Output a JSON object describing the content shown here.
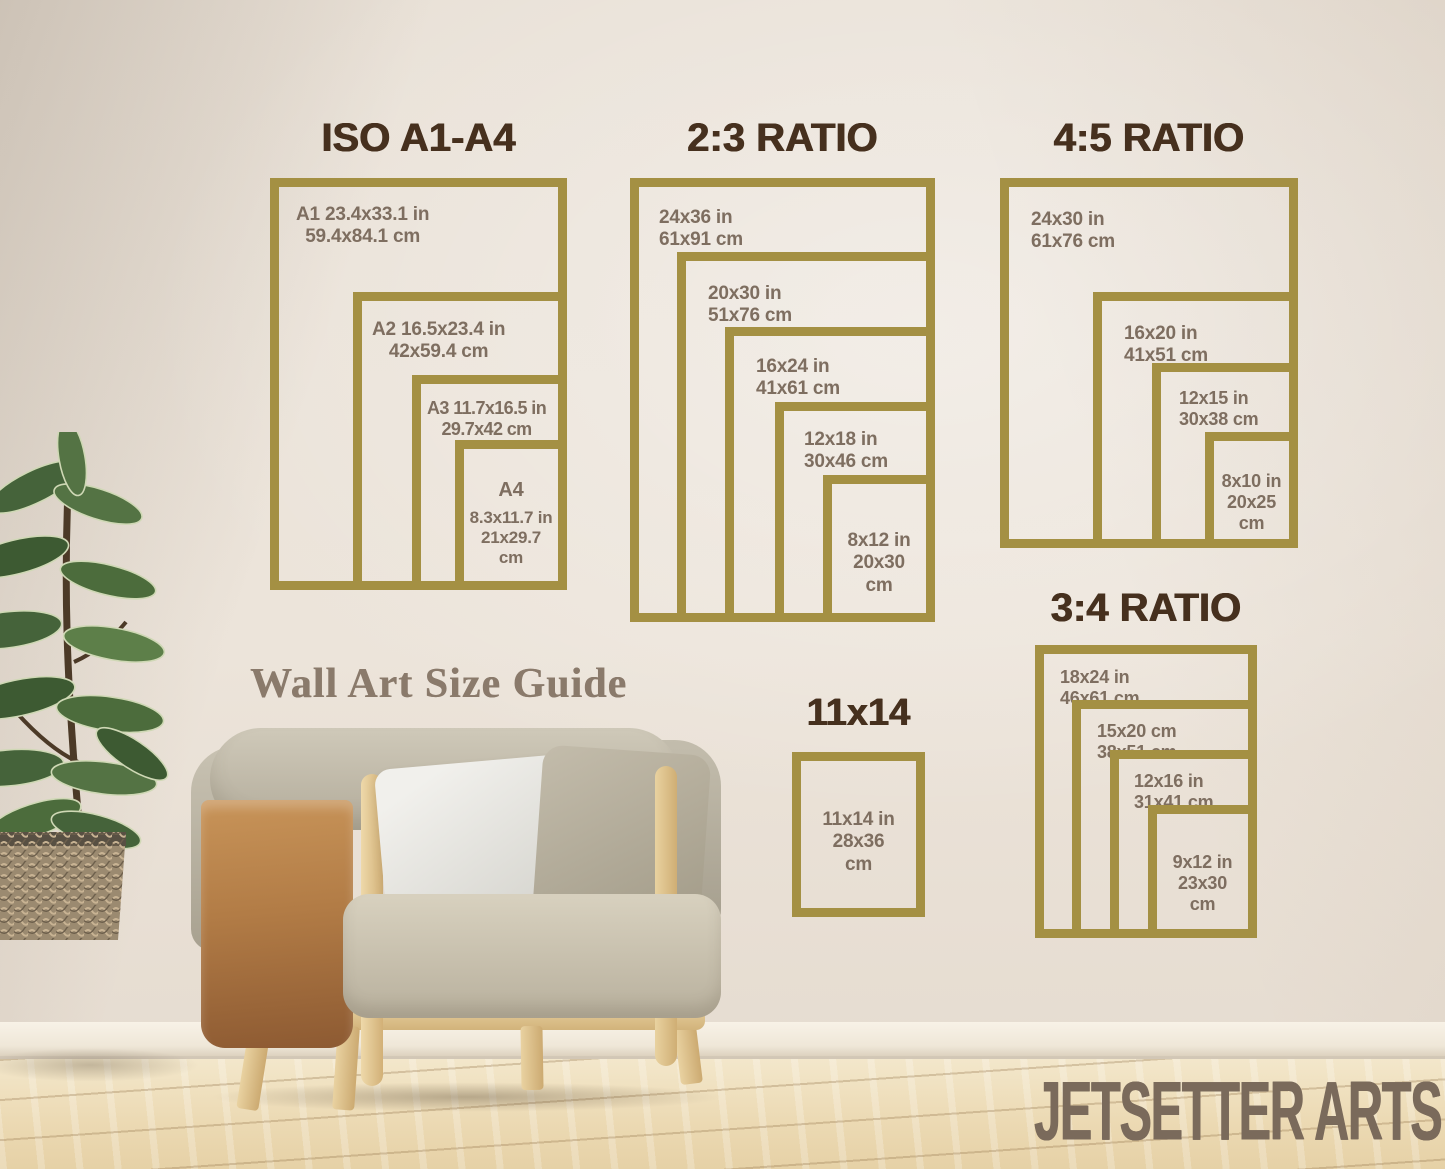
{
  "brand": "JETSETTER ARTS",
  "guide_title": "Wall Art Size Guide",
  "colors": {
    "frame_gold": "#a49043",
    "title_brown": "#46301e",
    "label_brown": "#7e6e60",
    "wall_cream": "#ece4da"
  },
  "sections": [
    {
      "title": "ISO A1-A4",
      "frames": [
        {
          "lines": [
            "A1 23.4x33.1 in",
            "59.4x84.1 cm"
          ]
        },
        {
          "lines": [
            "A2 16.5x23.4 in",
            "42x59.4 cm"
          ]
        },
        {
          "lines": [
            "A3 11.7x16.5 in",
            "29.7x42 cm"
          ]
        },
        {
          "lines": [
            "A4",
            "8.3x11.7 in",
            "21x29.7",
            "cm"
          ]
        }
      ]
    },
    {
      "title": "2:3 RATIO",
      "frames": [
        {
          "lines": [
            "24x36 in",
            "61x91 cm"
          ]
        },
        {
          "lines": [
            "20x30 in",
            "51x76 cm"
          ]
        },
        {
          "lines": [
            "16x24 in",
            "41x61 cm"
          ]
        },
        {
          "lines": [
            "12x18 in",
            "30x46 cm"
          ]
        },
        {
          "lines": [
            "8x12 in",
            "20x30",
            "cm"
          ]
        }
      ]
    },
    {
      "title": "4:5 RATIO",
      "frames": [
        {
          "lines": [
            "24x30 in",
            "61x76 cm"
          ]
        },
        {
          "lines": [
            "16x20 in",
            "41x51 cm"
          ]
        },
        {
          "lines": [
            "12x15 in",
            "30x38 cm"
          ]
        },
        {
          "lines": [
            "8x10 in",
            "20x25",
            "cm"
          ]
        }
      ]
    },
    {
      "title": "3:4 RATIO",
      "frames": [
        {
          "lines": [
            "18x24 in",
            "46x61 cm"
          ]
        },
        {
          "lines": [
            "15x20 cm",
            "38x51 cm"
          ]
        },
        {
          "lines": [
            "12x16 in",
            "31x41 cm"
          ]
        },
        {
          "lines": [
            "9x12 in",
            "23x30",
            "cm"
          ]
        }
      ]
    },
    {
      "title": "11x14",
      "frames": [
        {
          "lines": [
            "11x14 in",
            "28x36",
            "cm"
          ]
        }
      ]
    }
  ]
}
